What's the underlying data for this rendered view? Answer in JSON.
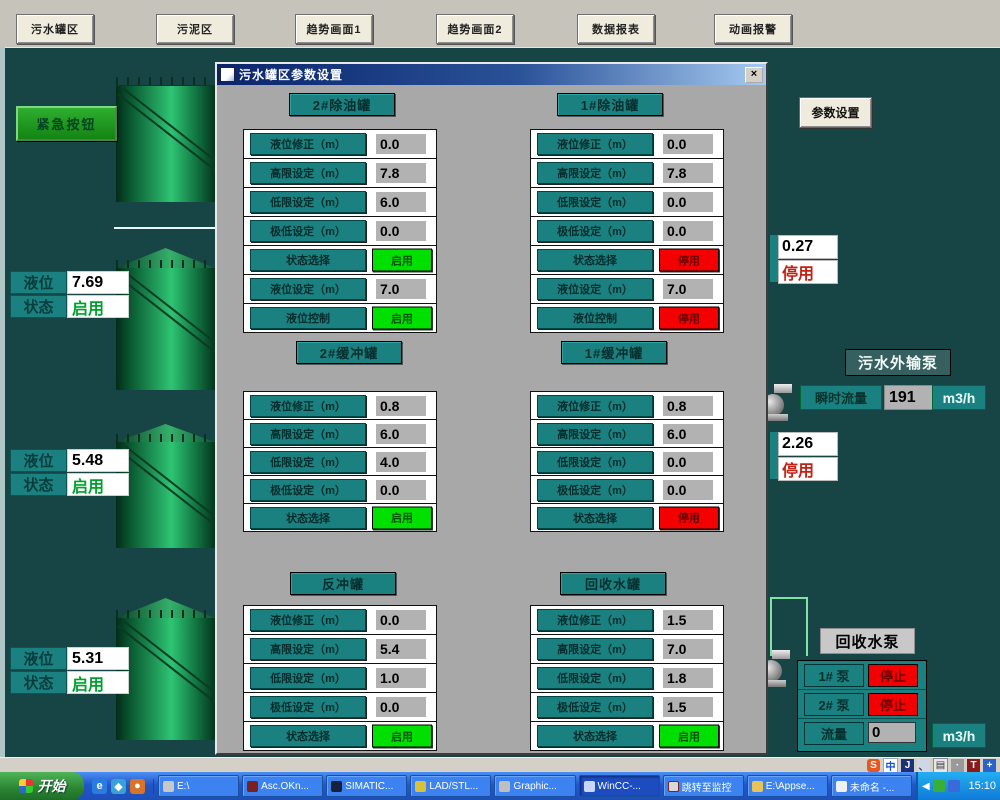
{
  "toolbar": {
    "buttons": [
      "污水罐区",
      "污泥区",
      "趋势画面1",
      "趋势画面2",
      "数据报表",
      "动画报警"
    ]
  },
  "scene": {
    "emergency_button": "紧急按钮",
    "settings_button": "参数设置",
    "tanks": [
      {
        "level_label": "液位",
        "level_value": "7.69",
        "status_label": "状态",
        "status_value": "启用"
      },
      {
        "level_label": "液位",
        "level_value": "5.48",
        "status_label": "状态",
        "status_value": "启用"
      },
      {
        "level_label": "液位",
        "level_value": "5.31",
        "status_label": "状态",
        "status_value": "启用"
      }
    ],
    "right_levels": [
      {
        "value": "0.27",
        "status": "停用"
      },
      {
        "value": "2.26",
        "status": "停用"
      }
    ],
    "export_pump": {
      "title": "污水外输泵",
      "flow_label": "瞬时流量",
      "flow_value": "191",
      "flow_unit": "m3/h"
    },
    "recovery_pump": {
      "title": "回收水泵",
      "pump1_label": "1# 泵",
      "pump1_status": "停止",
      "pump2_label": "2# 泵",
      "pump2_status": "停止",
      "flow_label": "流量",
      "flow_value": "0",
      "flow_unit": "m3/h"
    }
  },
  "dialog": {
    "title": "污水罐区参数设置",
    "close_label": "×",
    "groups": [
      {
        "title": "2#除油罐",
        "rows": [
          {
            "label": "液位修正（m）",
            "value": "0.0"
          },
          {
            "label": "高限设定（m）",
            "value": "7.8"
          },
          {
            "label": "低限设定（m）",
            "value": "6.0"
          },
          {
            "label": "极低设定（m）",
            "value": "0.0"
          },
          {
            "label": "状态选择",
            "button": "启用"
          },
          {
            "label": "液位设定（m）",
            "value": "7.0"
          },
          {
            "label": "液位控制",
            "button": "启用"
          }
        ]
      },
      {
        "title": "1#除油罐",
        "rows": [
          {
            "label": "液位修正（m）",
            "value": "0.0"
          },
          {
            "label": "高限设定（m）",
            "value": "7.8"
          },
          {
            "label": "低限设定（m）",
            "value": "0.0"
          },
          {
            "label": "极低设定（m）",
            "value": "0.0"
          },
          {
            "label": "状态选择",
            "button": "停用"
          },
          {
            "label": "液位设定（m）",
            "value": "7.0"
          },
          {
            "label": "液位控制",
            "button": "停用"
          }
        ]
      },
      {
        "title": "2#缓冲罐",
        "rows": [
          {
            "label": "液位修正（m）",
            "value": "0.8"
          },
          {
            "label": "高限设定（m）",
            "value": "6.0"
          },
          {
            "label": "低限设定（m）",
            "value": "4.0"
          },
          {
            "label": "极低设定（m）",
            "value": "0.0"
          },
          {
            "label": "状态选择",
            "button": "启用"
          }
        ]
      },
      {
        "title": "1#缓冲罐",
        "rows": [
          {
            "label": "液位修正（m）",
            "value": "0.8"
          },
          {
            "label": "高限设定（m）",
            "value": "6.0"
          },
          {
            "label": "低限设定（m）",
            "value": "0.0"
          },
          {
            "label": "极低设定（m）",
            "value": "0.0"
          },
          {
            "label": "状态选择",
            "button": "停用"
          }
        ]
      },
      {
        "title": "反冲罐",
        "rows": [
          {
            "label": "液位修正（m）",
            "value": "0.0"
          },
          {
            "label": "高限设定（m）",
            "value": "5.4"
          },
          {
            "label": "低限设定（m）",
            "value": "1.0"
          },
          {
            "label": "极低设定（m）",
            "value": "0.0"
          },
          {
            "label": "状态选择",
            "button": "启用"
          }
        ]
      },
      {
        "title": "回收水罐",
        "rows": [
          {
            "label": "液位修正（m）",
            "value": "1.5"
          },
          {
            "label": "高限设定（m）",
            "value": "7.0"
          },
          {
            "label": "低限设定（m）",
            "value": "1.8"
          },
          {
            "label": "极低设定（m）",
            "value": "1.5"
          },
          {
            "label": "状态选择",
            "button": "启用"
          }
        ]
      }
    ]
  },
  "statusbar": {
    "language_icons": [
      "S",
      "中",
      "J",
      "、",
      "▤",
      "·",
      "T",
      "+"
    ]
  },
  "taskbar": {
    "start_label": "开始",
    "tasks": [
      "E:\\",
      "Asc.OKn...",
      "SIMATIC...",
      "LAD/STL...",
      "Graphic...",
      "WinCC-...",
      "跳转至监控",
      "E:\\Appse...",
      "未命名 -..."
    ],
    "clock": "15:10"
  },
  "colors": {
    "background_teal": "#174545",
    "label_teal": "#1b8080",
    "enabled_green": "#00e000",
    "disabled_red": "#f50000"
  }
}
